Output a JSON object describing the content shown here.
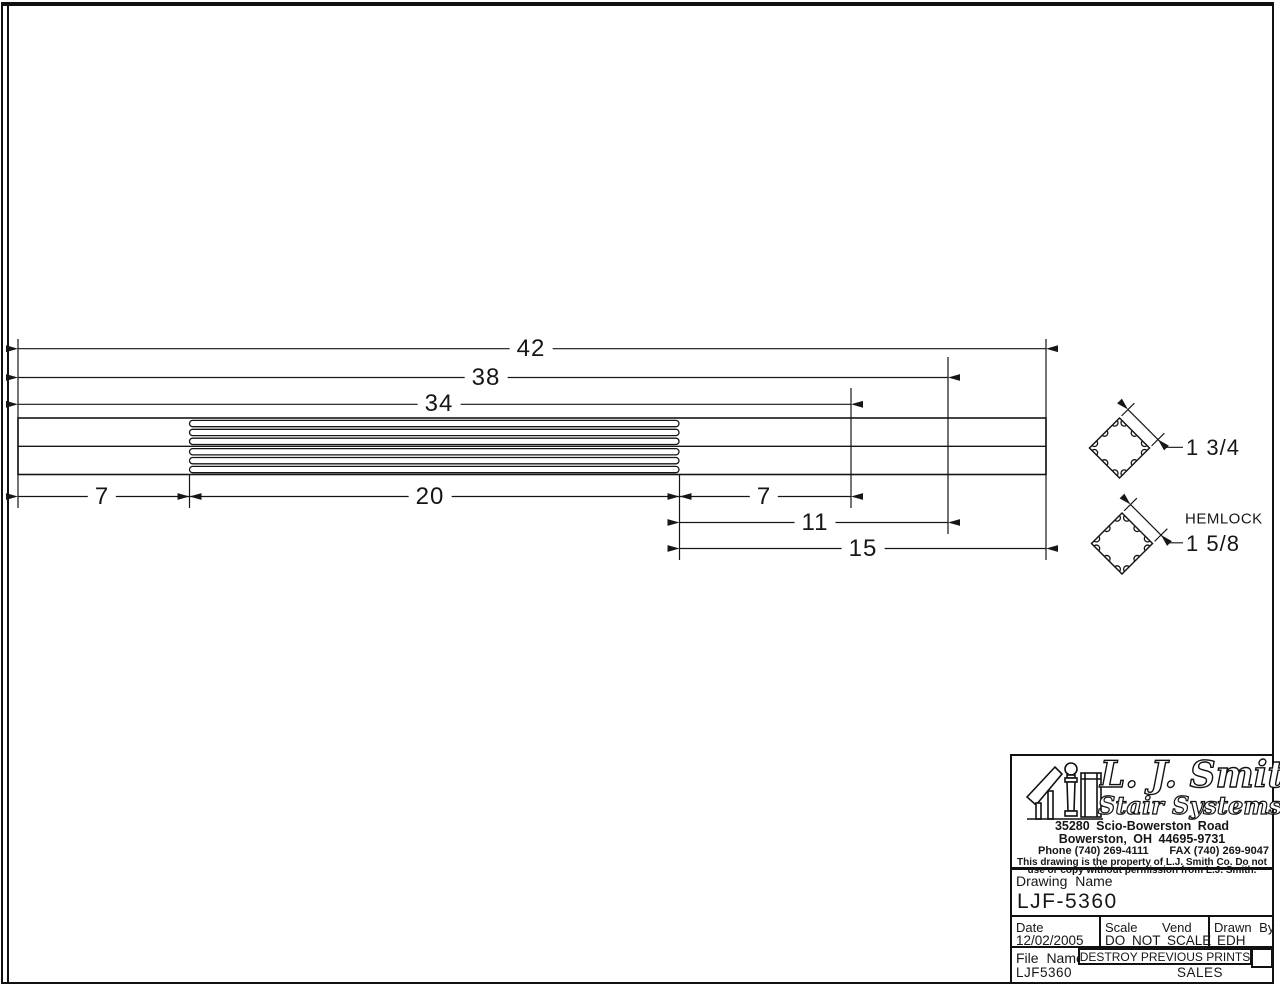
{
  "diagram": {
    "dims_top": {
      "overall": "42",
      "to_second_groove": "38",
      "to_first_groove": "34"
    },
    "dims_bottom": {
      "left_square": "7",
      "fluted_length": "20",
      "right_square": "7",
      "mid_span": "11",
      "right_span": "15"
    },
    "cross_sections": {
      "top_size": "1 3/4",
      "material": "HEMLOCK",
      "bottom_size": "1 5/8"
    }
  },
  "title_block": {
    "brand_line1": "L. J. Smith",
    "brand_line2": "Stair Systems",
    "address_line1": "35280 Scio-Bowerston Road",
    "address_line2": "Bowerston, OH 44695-9731",
    "phone": "Phone (740) 269-4111",
    "fax": "FAX (740) 269-9047",
    "notice_line1": "This drawing is the property of L.J. Smith Co. Do not",
    "notice_line2": "use or copy without permission from L.J. Smith.",
    "drawing_name_label": "Drawing Name",
    "drawing_name": "LJF-5360",
    "date_label": "Date",
    "scale_label": "Scale",
    "vend_label": "Vend",
    "drawn_by_label": "Drawn By",
    "date_value": "12/02/2005",
    "scale_value": "DO NOT SCALE",
    "drawn_by_value": "EDH",
    "file_name_label": "File Name",
    "file_name_value": "LJF5360",
    "destroy_notice": "DESTROY PREVIOUS PRINTS",
    "sales_label": "SALES"
  }
}
